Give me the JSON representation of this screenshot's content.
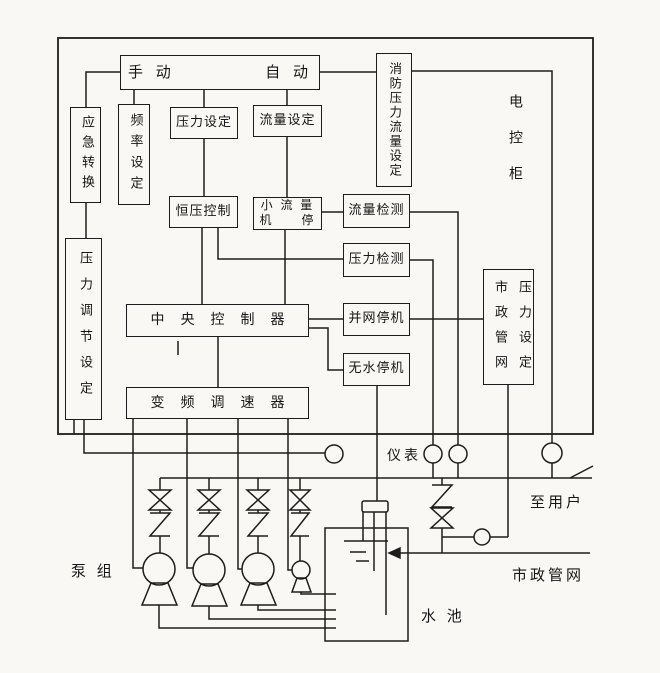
{
  "diagram": {
    "cabinet": {
      "label": "电控柜"
    },
    "blocks": {
      "manual": "手 动",
      "auto": "自 动",
      "fire_pressure_flow_setting": "消防压力流量设定",
      "emergency_transfer": "应急转换",
      "frequency_setting": "频率设定",
      "pressure_setting": "压力设定",
      "flow_setting": "流量设定",
      "constant_pressure_control": "恒压控制",
      "small_flow_stop_line1": "小 流 量",
      "small_flow_stop_line2": "机　　停",
      "flow_detection": "流量检测",
      "pressure_detection": "压力检测",
      "grid_connect_stop": "并网停机",
      "no_water_stop": "无水停机",
      "municipal_network_pressure_setting": "市政管网压力设定",
      "central_controller": "中央控制器",
      "vfd_speed_controller": "变频调速器",
      "pressure_adjust_setting": "压力调节设定"
    },
    "labels": {
      "instruments": "仪表",
      "to_users": "至用户",
      "municipal_network": "市政管网",
      "water_tank": "水 池",
      "pump_group": "泵 组"
    },
    "colors": {
      "ink": "#1d1d1d",
      "paper": "#f9f8f4"
    }
  }
}
